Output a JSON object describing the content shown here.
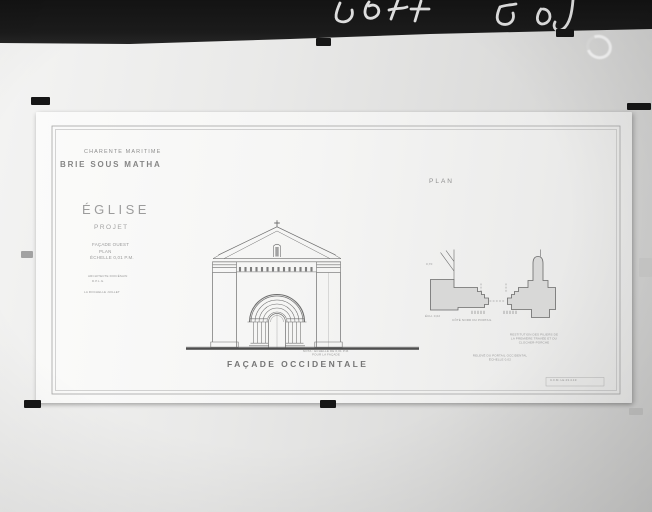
{
  "photo": {
    "inscription": "58 67 505",
    "colors": {
      "mount_black": "#1a1a1a",
      "board_gray": "#e2e2e1",
      "sheet_white": "#f7f7f6",
      "ink_gray": "#6f6f6f"
    }
  },
  "titleblock": {
    "department": "CHARENTE MARITIME",
    "commune": "BRIE SOUS MATHA",
    "building": "ÉGLISE",
    "project": "PROJET",
    "piece_lines": [
      "FAÇADE OUEST",
      "PLAN",
      "ÉCHELLE 0,01 P.M."
    ],
    "architect_lines": [
      "ARCHITECTE DIOCÉSAIN",
      "D.P.L.G."
    ],
    "place_date": "LA ROCHELLE JUILLET"
  },
  "facade": {
    "caption": "FAÇADE OCCIDENTALE",
    "note_lines": [
      "NOTA : ÉCHELLE DE 0,01 P.M.",
      "POUR LA FAÇADE"
    ]
  },
  "plan": {
    "title": "PLAN",
    "dim_label": "0,70",
    "scale_label": "ÉCH. 0,02",
    "left_caption": "CÔTÉ NORD DU PORTAIL",
    "right_caption_lines": [
      "RESTITUTION DES PILIERS DE",
      "LA PREMIÈRE TRAVÉE ET DU",
      "CLOCHER-PORCHE"
    ],
    "bottom_caption_lines": [
      "RELEVÉ DU PORTAIL OCCIDENTAL",
      "ÉCHELLE 0,02"
    ]
  },
  "signature": "C.F.M. LE 23.4.19"
}
